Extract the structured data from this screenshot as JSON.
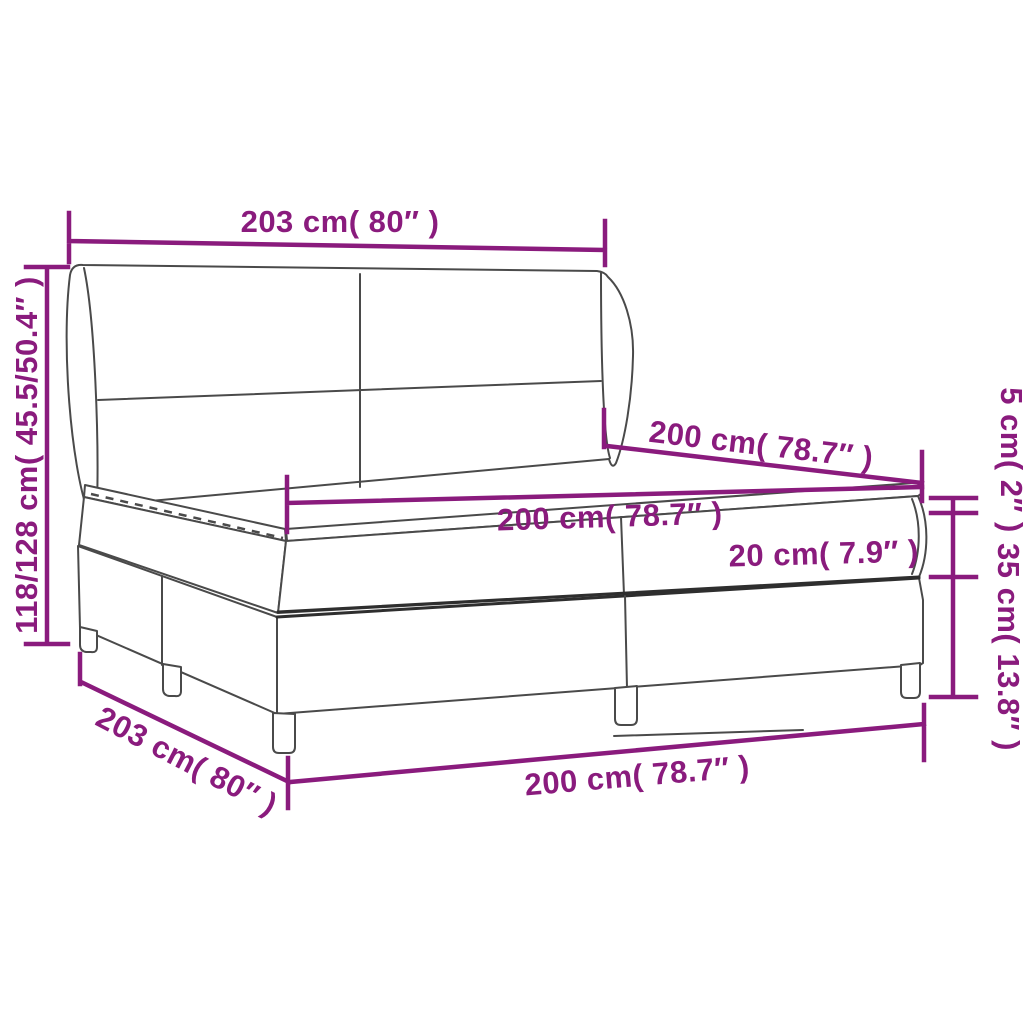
{
  "diagram": {
    "type": "product-dimension-diagram",
    "subject": "box-spring-bed-with-headboard-mattress-and-topper",
    "colors": {
      "background": "#ffffff",
      "drawing_outline": "#4a4a4a",
      "dimension_accent": "#8a1b7d"
    },
    "labels": {
      "headboard_width": "203 cm( 80″ )",
      "total_height": "118/128 cm( 45.5/50.4″ )",
      "length_top": "200 cm( 78.7″ )",
      "length_middle": "200 cm( 78.7″ )",
      "mattress_height": "20 cm( 7.9″ )",
      "topper_height": "5 cm( 2″ )",
      "base_height": "35 cm( 13.8″ )",
      "base_width_diagonal": "203 cm( 80″ )",
      "length_bottom": "200 cm( 78.7″ )"
    }
  }
}
